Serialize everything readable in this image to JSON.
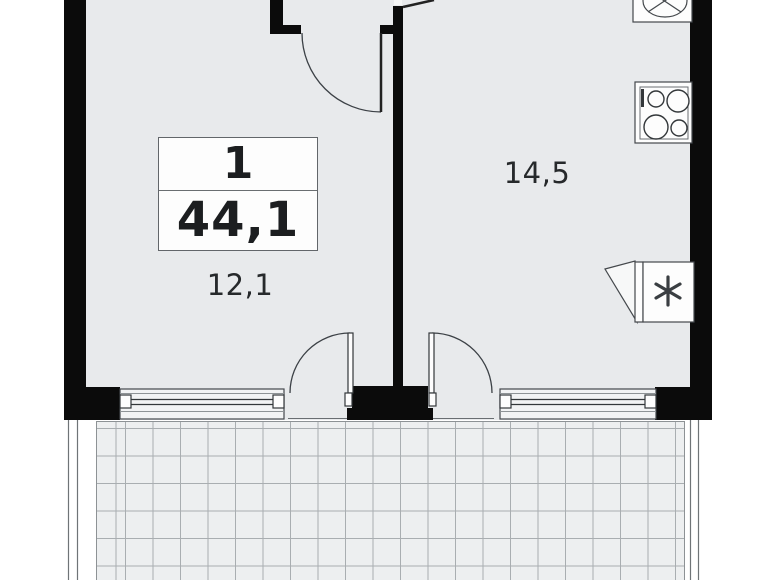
{
  "floorplan": {
    "unit_info": {
      "rooms_count": "1",
      "total_area": "44,1"
    },
    "rooms": [
      {
        "id": "living-room",
        "area": "12,1"
      },
      {
        "id": "kitchen",
        "area": "14,5"
      }
    ],
    "fixtures": {
      "sink-icon": "ellipse-basin-with-cross",
      "stove-icon": "four-burner-cooktop",
      "fridge-icon": "snowflake-asterisk"
    },
    "colors": {
      "wall": "#0b0b0b",
      "floor": "#e8eaec",
      "balcony_floor": "#edeff0",
      "grid_line": "#a9aeb1",
      "outline": "#3c4146",
      "background": "#ffffff",
      "text": "#1c1e20"
    }
  }
}
